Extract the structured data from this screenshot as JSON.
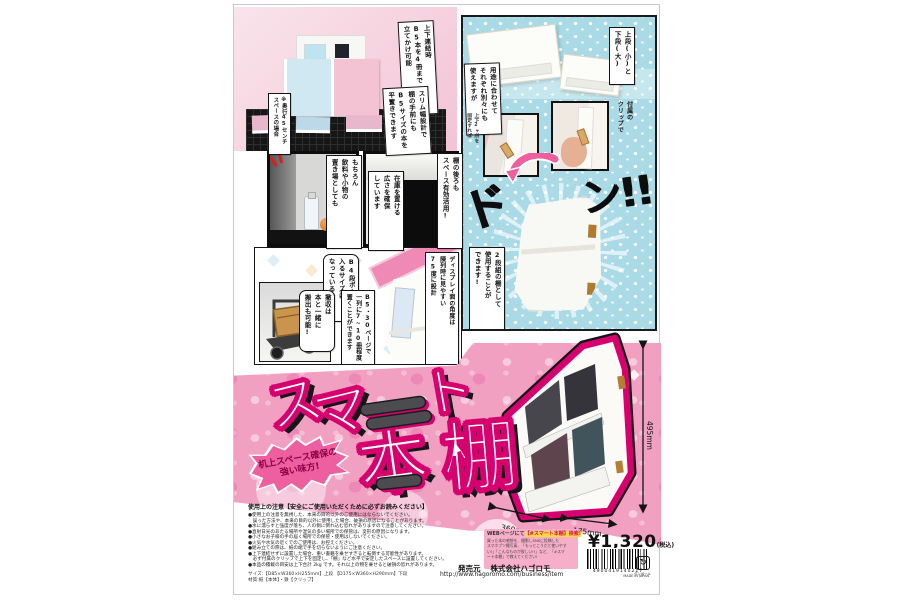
{
  "colors": {
    "accent": "#d6006f",
    "band_pink": "#f1a0c2",
    "panel_blue": "#a9dae6"
  },
  "top_photo": {
    "bubble_lean": "上下連結時\nB5本を4冊まで\n立てかけ可能",
    "bubble_flat": "スリム幅設計で\n棚の手前にも\nB5サイズの本を\n平置きできます",
    "note_depth": "※奥行45センチ\nスペースの場合"
  },
  "blue_panel": {
    "bubble_tiers": "上段(小)と\n下段(大)",
    "bubble_separate": "用途に合わせて\nそれぞれ別々にも\n使えますが",
    "label_clip": "付属の\nクリップで",
    "label_fix": "上下2ヶ所を\n固定すれば",
    "sfx_left": "ド",
    "sfx_right": "ン!!",
    "bubble_result": "2段組の棚として\n使用することが\nできます!"
  },
  "photo_row": {
    "bubble_personal": "もちろん\n飲料や小物の\n置き場としても",
    "bubble_behind": "棚の後ろも\nスペース有効活用!",
    "bubble_stock": "在庫を置ける\n広さを確保\nしています"
  },
  "comic_row": {
    "bubble_box": "B4段ボールに\n入るサイズに\nなっているので",
    "bubble_carry": "撤収は\n本と一緒に\n搬出も可能!",
    "bubble_capacity": "B5・30ページで\n一列に7~10冊程度\n置くことができます",
    "bubble_angle": "ディスプレイ面の角度は\n陳列時に見やすい\n75度に設計"
  },
  "hero": {
    "title_su": "ス",
    "title_ma": "マ",
    "title_to": "ト",
    "title_hon": "本",
    "title_dana": "棚",
    "badge_line1": "机上スペース確保の",
    "badge_line2": "強い味方!"
  },
  "diagram": {
    "height": "495mm",
    "width": "360mm",
    "depth": "175mm"
  },
  "footer": {
    "notes_title": "使用上の注意【安全にご使用いただくために必ずお読みください】",
    "notes": [
      "●使用上の注意を無視した、本来の目的以外のご使用にはならないでください。",
      "　誤った方法や、本来の目的以外に使用した場合、破損の原因になることがあります。",
      "●水に濡らすと強度が落ち、人の側に倒れ込む恐れがありますので注意してください。",
      "●直射日光のあたる場所や湿気の多い場所での保管は、変形の原因になります。",
      "●小さなお子様の手の届く場所での保管・使用はしないでください。",
      "●火気や水気の近くでのご使用は、お控えください。",
      "●組み立ての際は、紙の端で手を切らないようにご注意ください。",
      "●上下連結せずに設置した場合、重い書籍を乗せすぎると転倒する可能性があります。",
      "　必ず付属のクリップで上下を固定し、「棚」など水平で安定したスペースに設置してください。",
      "●本品の積載の目安は上下合計 2kg です。それ以上の物を乗せると破損の恐れがあります。"
    ],
    "size_line1": "サイズ:【D85×W360×H255mm】上段 【D175×W360×H290mm】下段",
    "size_line2": "材質:紙【本体】・鉄【クリップ】",
    "promo_title_pre": "WEBページにて",
    "promo_title_hl": "【#スマート本棚】検索!",
    "promo_lines": [
      "買った本の感想を、撮影しSNSに投稿した",
      "スマホブツ撮写真、「もっとこうだと使いやす",
      "い!」「こんなものが欲しい!!」など、「#スマ",
      "ート本棚」で教えてください!"
    ],
    "price": "¥1,320",
    "price_tax": "(税込)",
    "publisher_label": "発売元",
    "publisher": "株式会社ハゴロモ",
    "url": "http://www.hagoromo.com/business/item",
    "barcode_number": "4900419140217",
    "made_in": "MADE IN JAPAN",
    "recycle_label": "ダンボール"
  }
}
